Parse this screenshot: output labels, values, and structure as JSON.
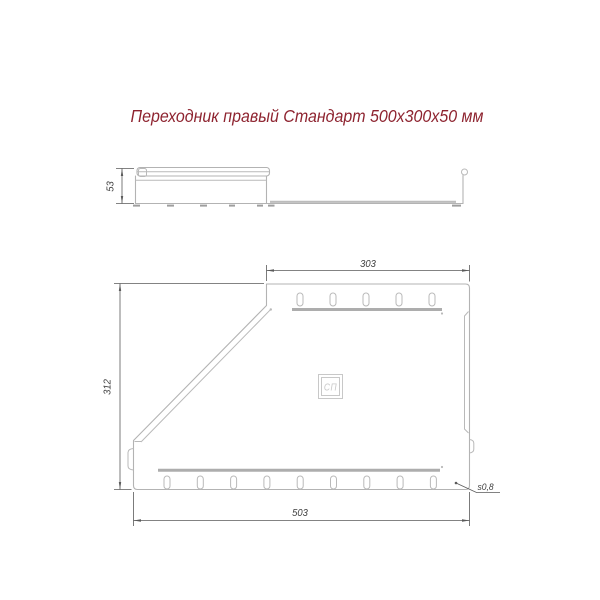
{
  "title": "Переходник правый Стандарт 500х300х50 мм",
  "colors": {
    "title_text": "#8e2430",
    "part_outline": "#b3b3b3",
    "rib": "#adadad",
    "dimension": "#5a5a5a",
    "logo": "#c8c8c8",
    "background": "#ffffff"
  },
  "side_view": {
    "height_dim": "53"
  },
  "top_view": {
    "top_width_dim": "303",
    "height_dim": "312",
    "bottom_width_dim": "503",
    "thickness_dim": "s0,8",
    "logo_text": "СП",
    "slots": {
      "top_count": 5,
      "bottom_count": 9
    }
  }
}
